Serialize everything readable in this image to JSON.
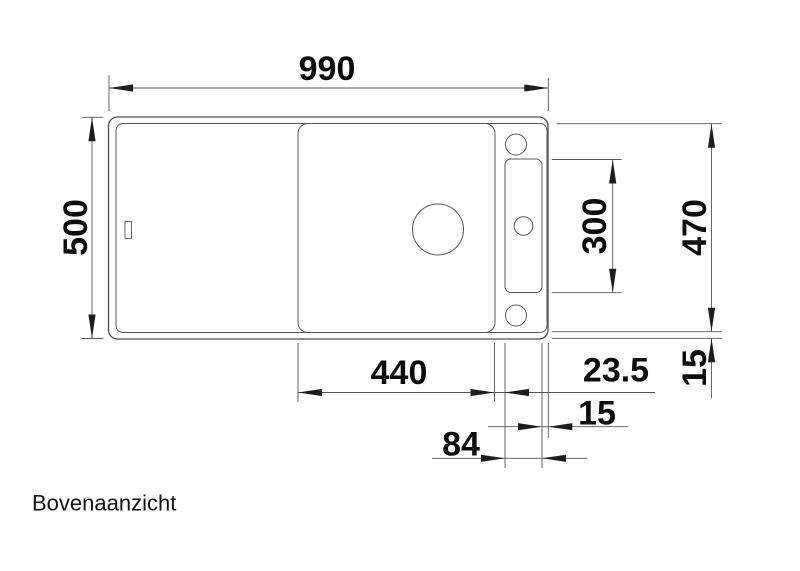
{
  "page": {
    "background_color": "#ffffff",
    "line_color": "#555555",
    "text_color": "#111111"
  },
  "drawing": {
    "view_label": "Bovenaanzicht",
    "dimensions": {
      "total_width": "990",
      "total_depth": "500",
      "ledge_cutout_length": "300",
      "inner_depth": "470",
      "rim_right": "15",
      "bowl_width": "440",
      "bowl_to_ledge_gap": "23.5",
      "ledge_to_edge": "15",
      "ledge_width": "84"
    }
  }
}
